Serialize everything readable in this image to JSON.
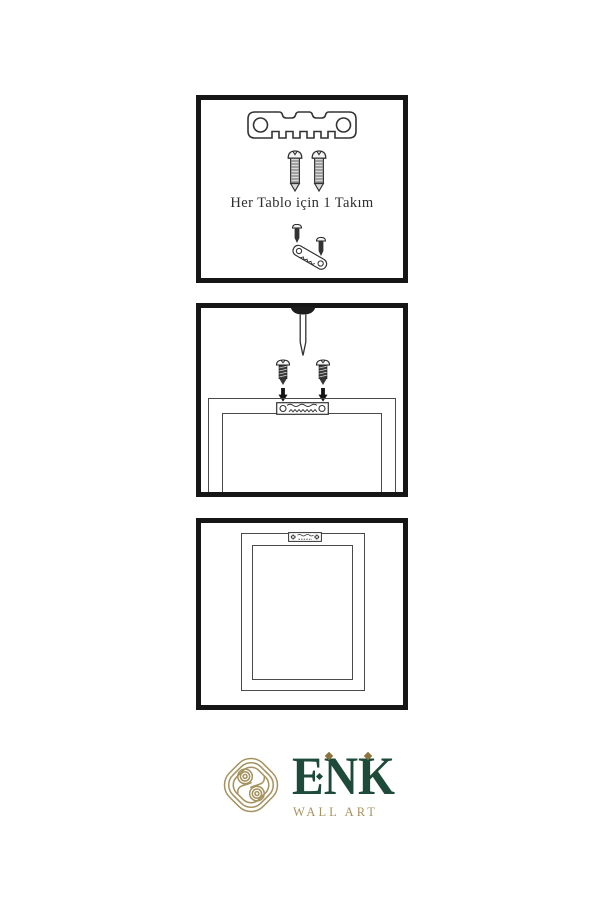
{
  "document": {
    "background": "#ffffff",
    "type": "wall-art-hanging-instruction-sheet"
  },
  "colors": {
    "panel_border": "#161616",
    "line_art": "#333333",
    "frame_line": "#4a4a4a",
    "logo_gold": "#a5935f",
    "logo_green": "#1e4b39"
  },
  "panels": {
    "kit": {
      "caption": "Her Tablo için 1 Takım",
      "icons": [
        "sawtooth-hanger-bar",
        "screw",
        "screw",
        "sawtooth-hanger-with-screws"
      ]
    },
    "install": {
      "icons": [
        "nail",
        "screw",
        "screw",
        "down-arrow",
        "down-arrow",
        "frame-back-top-with-sawtooth-hanger"
      ]
    },
    "result": {
      "icons": [
        "frame-back-with-mounted-hanger"
      ]
    }
  },
  "logo": {
    "brand": "ENK",
    "subtitle": "WALL ART",
    "icon": "knot-monogram"
  }
}
